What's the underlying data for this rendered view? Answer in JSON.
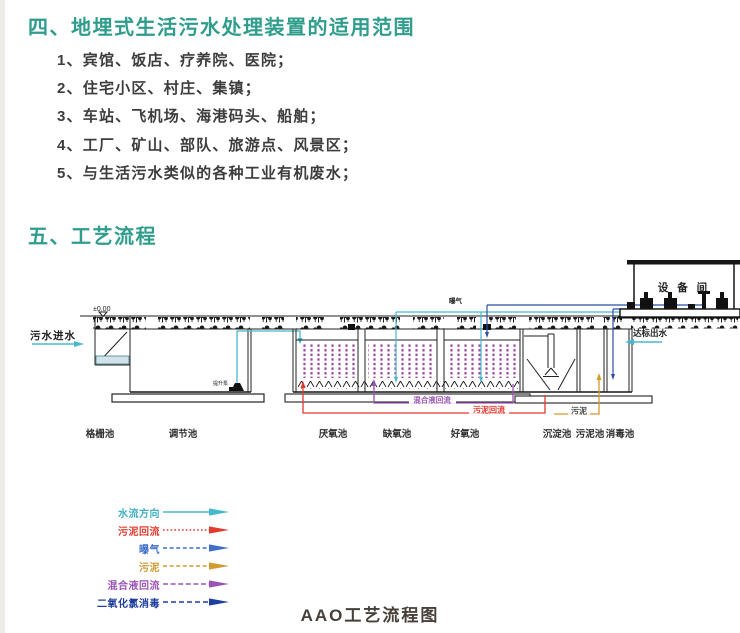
{
  "section4": {
    "heading": "四、地埋式生活污水处理装置的适用范围",
    "items": [
      "1、宾馆、饭店、疗养院、医院；",
      "2、住宅小区、村庄、集镇；",
      "3、车站、飞机场、海港码头、船舶；",
      "4、工厂、矿山、部队、旅游点、风景区；",
      "5、与生活污水类似的各种工业有机废水；"
    ]
  },
  "section5": {
    "heading": "五、工艺流程"
  },
  "diagram": {
    "level_mark": "±0.00",
    "inlet_label": "污水进水",
    "aeration_label": "曝气",
    "equipment_room_label": "设 备 间",
    "outlet_label": "达标出水",
    "lift_pump_label": "提升泵",
    "mixed_liquor_return_label": "混合液回流",
    "sludge_return_label": "污泥回流",
    "sludge_label": "污泥",
    "tanks": [
      "格栅池",
      "调节池",
      "厌氧池",
      "缺氧池",
      "好氧池",
      "沉淀池",
      "污泥池",
      "消毒池"
    ],
    "colors": {
      "heading_accent": "#2f9d8c",
      "water_flow": "#49b8cf",
      "sludge_return": "#e03a30",
      "aeration": "#49b8cf",
      "sludge": "#d39a2e",
      "mixed_liquor_return": "#9a53b4",
      "chlorine_dosing": "#2b4fa7",
      "media_fill": "#9a4d9e"
    }
  },
  "legend": {
    "items": [
      {
        "label": "水流方向",
        "color": "#3fb0c4",
        "line": "solid"
      },
      {
        "label": "污泥回流",
        "color": "#e23a2e",
        "line": "dotted"
      },
      {
        "label": "曝气",
        "color": "#3f6fc8",
        "line": "dashed"
      },
      {
        "label": "污泥",
        "color": "#cf9a2e",
        "line": "dashed"
      },
      {
        "label": "混合液回流",
        "color": "#9a53b4",
        "line": "dashed"
      },
      {
        "label": "二氧化氯消毒",
        "color": "#1e3f9e",
        "line": "dashed"
      }
    ]
  },
  "caption": "AAO工艺流程图"
}
